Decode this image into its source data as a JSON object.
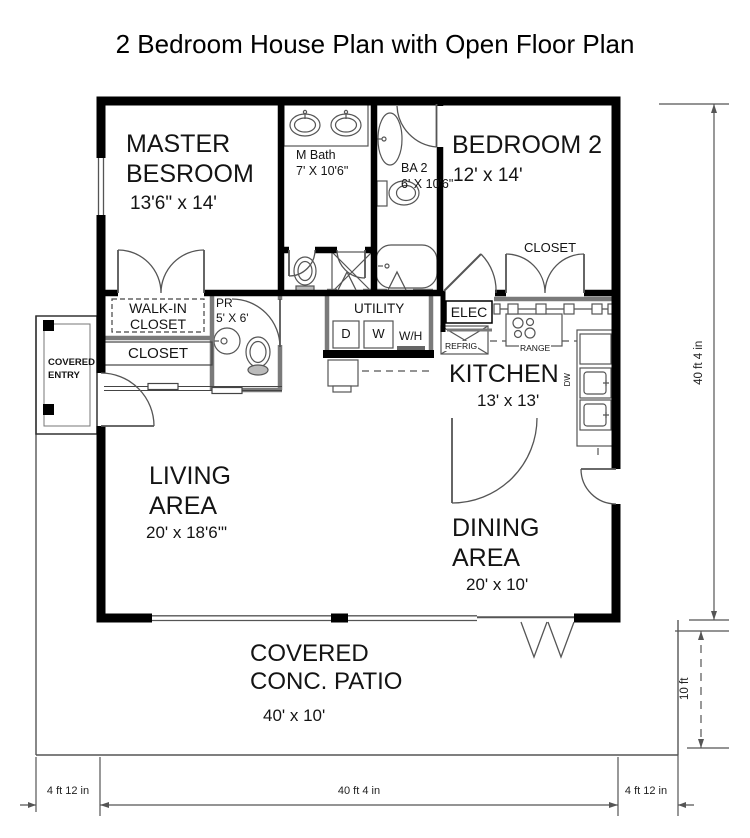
{
  "title": "2 Bedroom House Plan with Open Floor Plan",
  "rooms": {
    "master_bedroom": {
      "name": "MASTER\nBESROOM",
      "dims": "13'6\" x 14'"
    },
    "m_bath": {
      "label": "M Bath\n7' X 10'6\""
    },
    "bath2": {
      "label": "BA 2\n6' X 10'6\""
    },
    "bedroom2": {
      "name": "BEDROOM 2",
      "dims": "12' x 14'"
    },
    "bedroom2_closet": {
      "label": "CLOSET"
    },
    "walk_in_closet": {
      "label": "WALK-IN\nCLOSET"
    },
    "powder_room": {
      "label": "PR\n5' X 6'"
    },
    "hall_closet": {
      "label": "CLOSET"
    },
    "utility": {
      "label": "UTILITY",
      "dryer": "D",
      "washer": "W",
      "water_heater": "W/H"
    },
    "elec_panel": {
      "label": "ELEC"
    },
    "kitchen": {
      "name": "KITCHEN",
      "dims": "13' x 13'",
      "refrigerator": "REFRIG",
      "range": "RANGE",
      "dishwasher": "DW"
    },
    "living_area": {
      "name": "LIVING\nAREA",
      "dims": "20' x 18'6'\""
    },
    "dining_area": {
      "name": "DINING\nAREA",
      "dims": "20' x 10'"
    },
    "patio": {
      "name": "COVERED\nCONC. PATIO",
      "dims": "40' x 10'"
    },
    "covered_entry": {
      "label": "COVERED\nENTRY"
    }
  },
  "dimensions": {
    "bottom_left": "4 ft 12 in",
    "bottom_center": "40 ft 4 in",
    "bottom_right": "4 ft 12 in",
    "right_height": "40 ft 4 in",
    "patio_depth": "10 ft"
  },
  "colors": {
    "wall": "#000000",
    "half_wall": "#7a7a7a",
    "dimension": "#555555",
    "background": "#ffffff"
  }
}
